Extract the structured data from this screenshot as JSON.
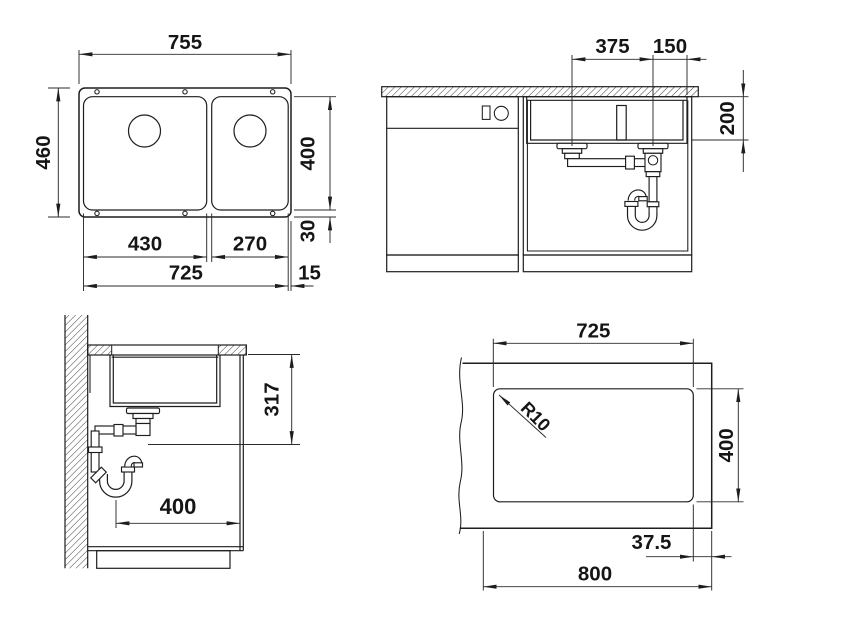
{
  "palette": {
    "background": "#ffffff",
    "line": "#1d1d1d",
    "text": "#151515"
  },
  "views": {
    "top": {
      "overall_width": "755",
      "overall_depth": "460",
      "bowl_inner_depth": "400",
      "left_bowl_width": "430",
      "right_bowl_width": "270",
      "bowls_outer_span": "725",
      "right_edge_margin": "15",
      "bottom_edge_margin": "30"
    },
    "front": {
      "drain_spacing": "375",
      "drain_to_edge": "150",
      "bowl_depth": "200"
    },
    "side": {
      "drain_outlet_height": "317",
      "min_cabinet_depth": "400"
    },
    "cutout": {
      "cutout_width": "725",
      "cutout_depth": "400",
      "corner_radius": "R10",
      "edge_offset": "37.5",
      "worktop_width": "800"
    }
  }
}
